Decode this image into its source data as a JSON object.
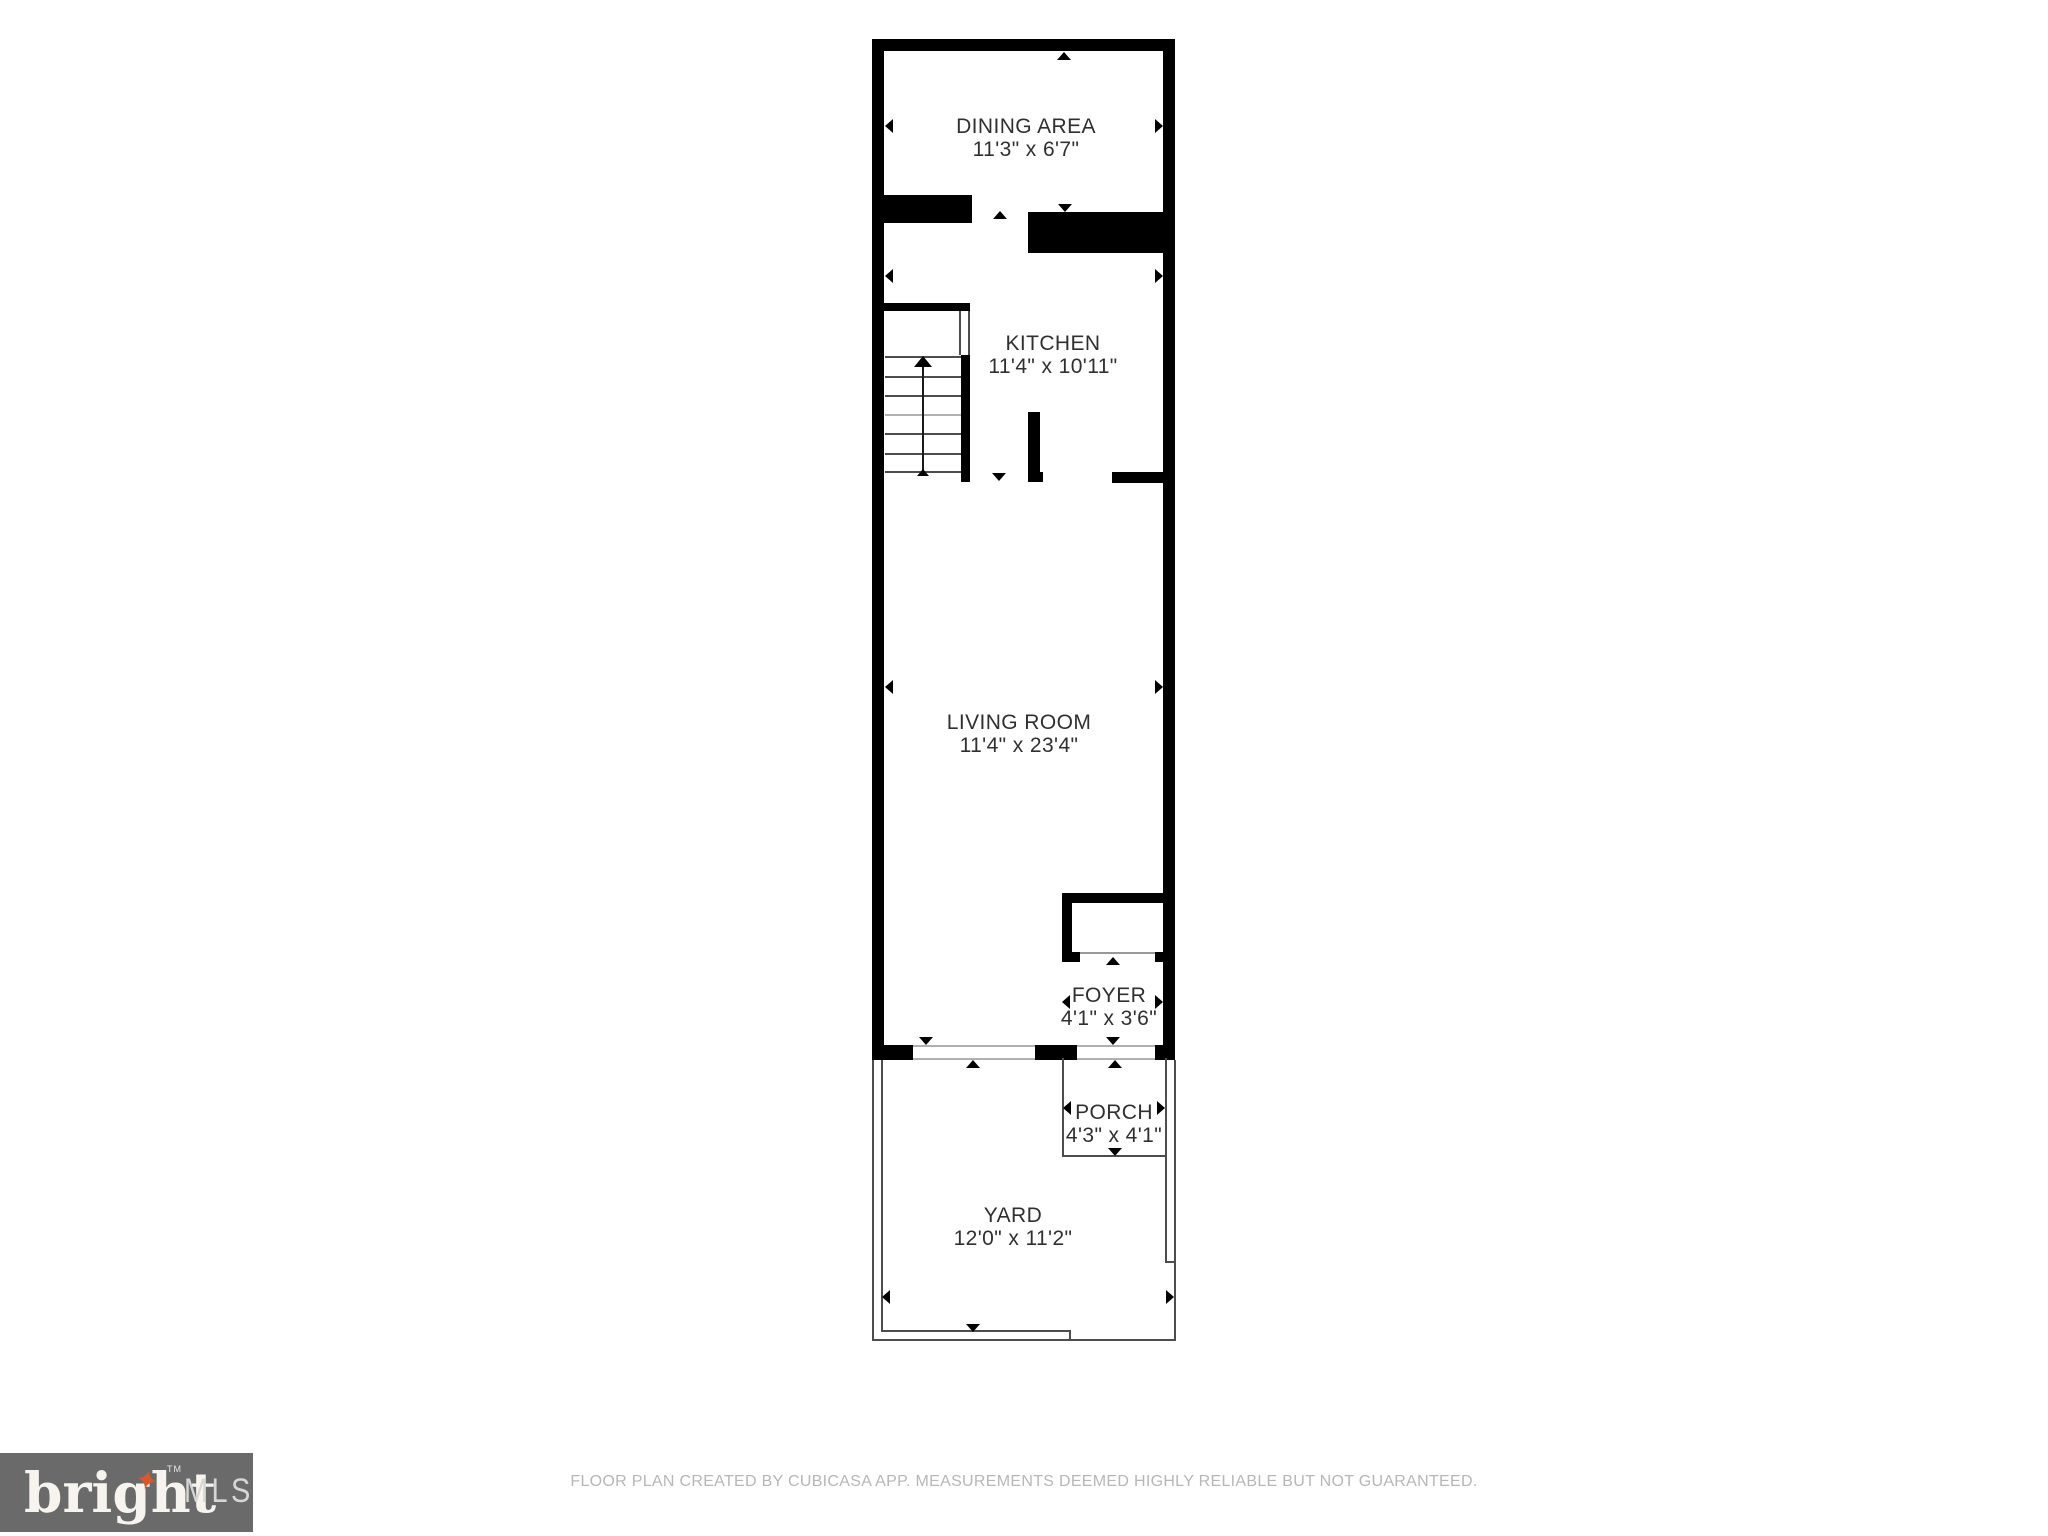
{
  "colors": {
    "wall": "#000000",
    "label": "#303030",
    "thin": "#4d4d4d",
    "threshold": "#b0b0b0",
    "footer_text": "#b7b7b7",
    "logo_bg": "#6a6a6a",
    "logo_text": "#f7f4ef",
    "logo_mls": "#d6d6d6",
    "logo_star": "#d9582b"
  },
  "plan": {
    "rooms": [
      {
        "id": "dining-area",
        "name": "DINING AREA",
        "dims": "11'3\" x 6'7\""
      },
      {
        "id": "kitchen",
        "name": "KITCHEN",
        "dims": "11'4\" x 10'11\""
      },
      {
        "id": "living-room",
        "name": "LIVING ROOM",
        "dims": "11'4\" x 23'4\""
      },
      {
        "id": "foyer",
        "name": "FOYER",
        "dims": "4'1\" x 3'6\""
      },
      {
        "id": "porch",
        "name": "PORCH",
        "dims": "4'3\" x 4'1\""
      },
      {
        "id": "yard",
        "name": "YARD",
        "dims": "12'0\" x 11'2\""
      }
    ]
  },
  "footer": {
    "disclaimer": "FLOOR PLAN CREATED BY CUBICASA APP. MEASUREMENTS DEEMED HIGHLY RELIABLE BUT NOT GUARANTEED."
  },
  "logo": {
    "brand": "bright",
    "tm": "TM",
    "suffix": "MLS",
    "star": "✦"
  }
}
